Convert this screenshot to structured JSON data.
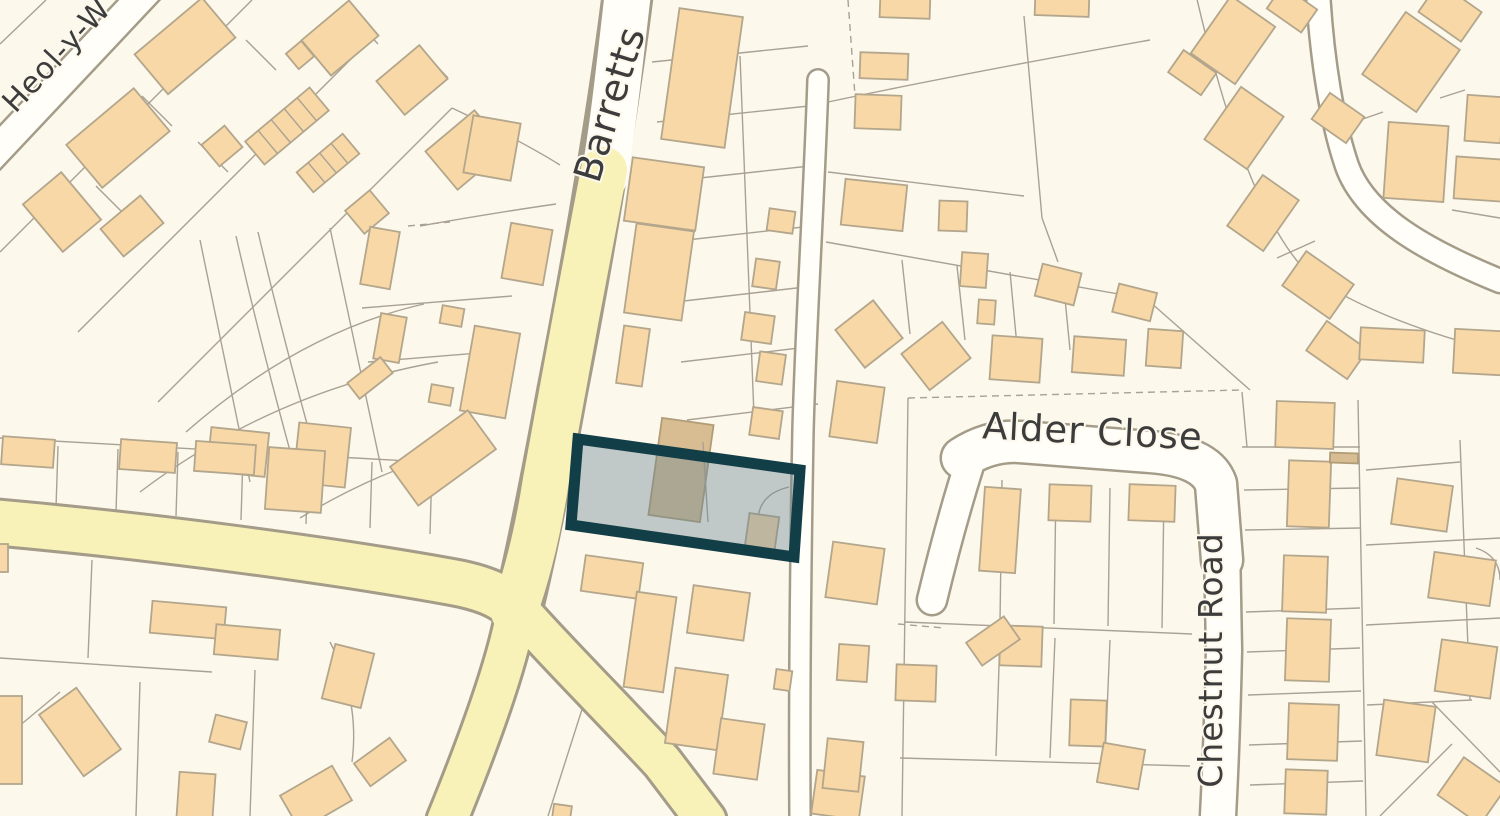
{
  "app": {
    "type": "map-viewer",
    "description": "Street map extract with a selected plot outlined in dark teal"
  },
  "map": {
    "street_labels": {
      "barretts": "Barretts",
      "alder_close": "Alder Close",
      "chestnut_road": "Chestnut Road",
      "heol_y": "Heol-y-W"
    },
    "highlighted_plot": {
      "present": true,
      "outline_color": "#123e47",
      "fill_color": "rgba(109,135,148,0.42)"
    },
    "palette": {
      "background": "#fcf8ec",
      "building_fill": "#f8d8a6",
      "building_stroke": "#b3a68c",
      "building_dark_fill": "#d9bd92",
      "road_yellow": "#f8f2b8",
      "road_casing": "#a49c88",
      "road_white": "#fffef9",
      "parcel_line": "#a9a294",
      "label_color": "#3c3c3c"
    }
  }
}
